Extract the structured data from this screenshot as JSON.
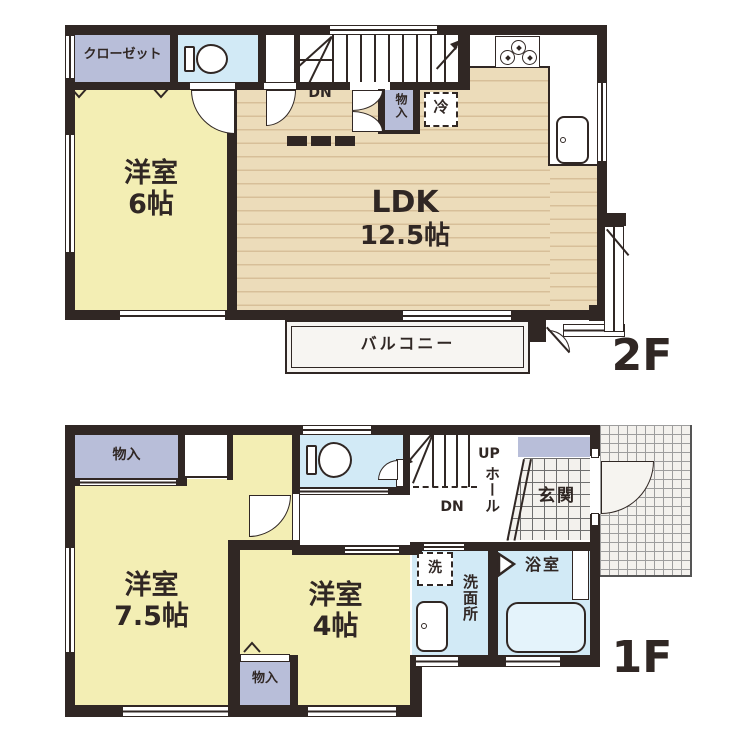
{
  "document_type": "floor-plan",
  "f2": {
    "floor": "2F",
    "closet": "クローゼット",
    "room6_name": "洋室",
    "room6_size": "6帖",
    "ldk_name": "LDK",
    "ldk_size": "12.5帖",
    "dn": "DN",
    "storage": "物入",
    "fridge": "冷",
    "balcony": "バルコニー"
  },
  "f1": {
    "floor": "1F",
    "storage_top": "物入",
    "room75_name": "洋室",
    "room75_size": "7.5帖",
    "room4_name": "洋室",
    "room4_size": "4帖",
    "storage_bottom": "物入",
    "up": "UP",
    "dn": "DN",
    "hall": "ホール",
    "entrance": "玄関",
    "washer": "洗",
    "washroom": "洗面所",
    "bath": "浴室"
  },
  "icons": [
    "toilet-icon",
    "stove-icon",
    "kitchen-sink-icon",
    "bathtub-icon",
    "washbasin-icon",
    "door-arc-icon",
    "stair-treads-icon"
  ],
  "colors": {
    "wall": "#302724",
    "room_yellow": "#f3eeb4",
    "wood_floor": "#ecdcba",
    "storage_lavender": "#b8bed9",
    "water_blue": "#d2eaf6",
    "tile_bg": "#f3f1ed",
    "balcony_fill": "#f7f5f2"
  }
}
